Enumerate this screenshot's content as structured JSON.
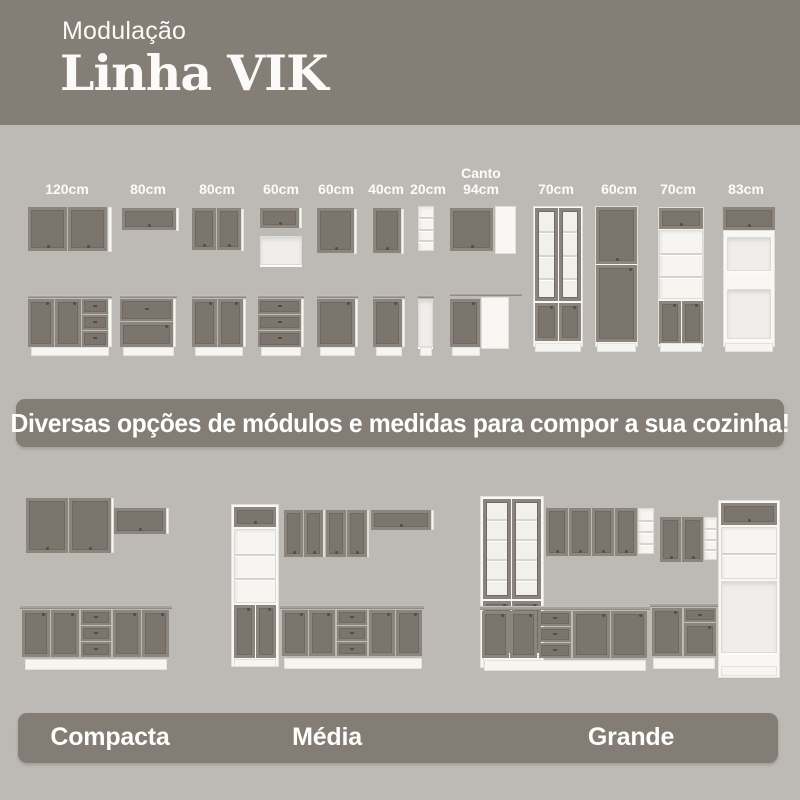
{
  "header": {
    "kicker": "Modulação",
    "title": "Linha VIK"
  },
  "modules": {
    "sizes": [
      "120cm",
      "80cm",
      "80cm",
      "60cm",
      "60cm",
      "40cm",
      "20cm",
      "Canto\n94cm",
      "70cm",
      "60cm",
      "70cm",
      "83cm"
    ]
  },
  "banner": {
    "text": "Diversas opções de módulos e medidas para compor a sua cozinha!"
  },
  "kitchens": [
    {
      "name": "Compacta"
    },
    {
      "name": "Média"
    },
    {
      "name": "Grande"
    }
  ],
  "colors": {
    "band": "#837d76",
    "background": "#bdbab5",
    "cabinet_gray": "#7b756e",
    "carcass_white": "#f8f7f4",
    "text": "#fdfdfb"
  }
}
